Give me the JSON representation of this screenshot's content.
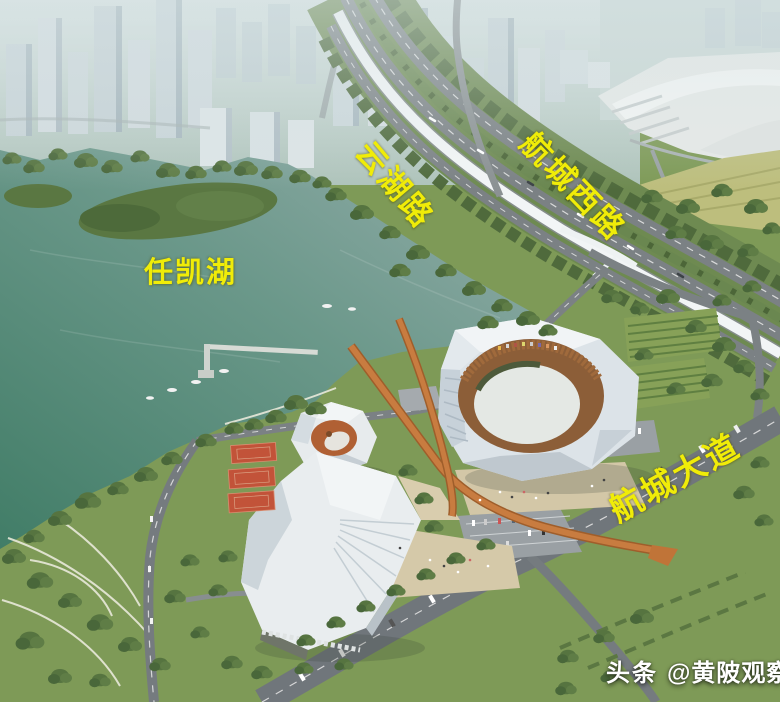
{
  "scene": {
    "labels": {
      "yunhu_road": "云湖路",
      "hangcheng_west_road": "航城西路",
      "renkai_lake": "任凯湖",
      "hangcheng_avenue": "航城大道"
    },
    "watermark": {
      "brand": "头条",
      "handle": "@黄陂观察"
    },
    "colors": {
      "label_yellow": "#f0ec08",
      "watermark_white": "#ffffff",
      "lake_teal": "#5d8f7f",
      "grass_green": "#7e9a57",
      "tree_green": "#4f6a3c",
      "road_gray": "#7b8184",
      "viaduct_white": "#f2f5f6",
      "skywalk_orange": "#c87c40",
      "court_red": "#c25339",
      "stadium_roof_white": "#edf1f3"
    }
  }
}
